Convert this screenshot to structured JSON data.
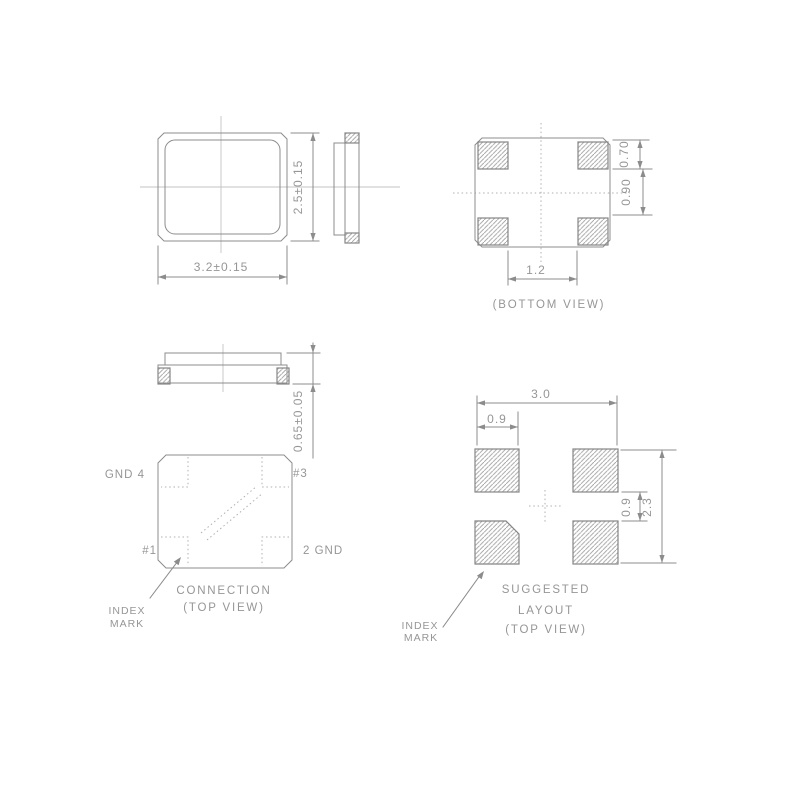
{
  "drawing": {
    "package_top_view": {
      "dim_width": "3.2±0.15",
      "dim_height": "2.5±0.15"
    },
    "bottom_view": {
      "dim_pad_height": "0.70",
      "dim_pad_gap": "0.90",
      "dim_pad_spacing": "1.2",
      "caption": "(BOTTOM VIEW)"
    },
    "front_view": {
      "dim_thickness": "0.65±0.05"
    },
    "connection_view": {
      "pin_4": "GND 4",
      "pin_3": "#3",
      "pin_1": "#1",
      "pin_2": "2 GND",
      "caption_line1": "CONNECTION",
      "caption_line2": "(TOP VIEW)",
      "index_label_line1": "INDEX",
      "index_label_line2": "MARK"
    },
    "suggested_layout": {
      "dim_width": "3.0",
      "dim_pad_width": "0.9",
      "dim_pad_gap": "0.9",
      "dim_height": "2.3",
      "caption_line1": "SUGGESTED",
      "caption_line2": "LAYOUT",
      "caption_line3": "(TOP VIEW)",
      "index_label_line1": "INDEX",
      "index_label_line2": "MARK"
    }
  },
  "colors": {
    "background": "#ffffff",
    "line": "#8c8c8c",
    "text": "#969696",
    "hatch": "#a0a0a0",
    "centerline": "#c3c3c3",
    "dotted": "#b0b0b0"
  }
}
